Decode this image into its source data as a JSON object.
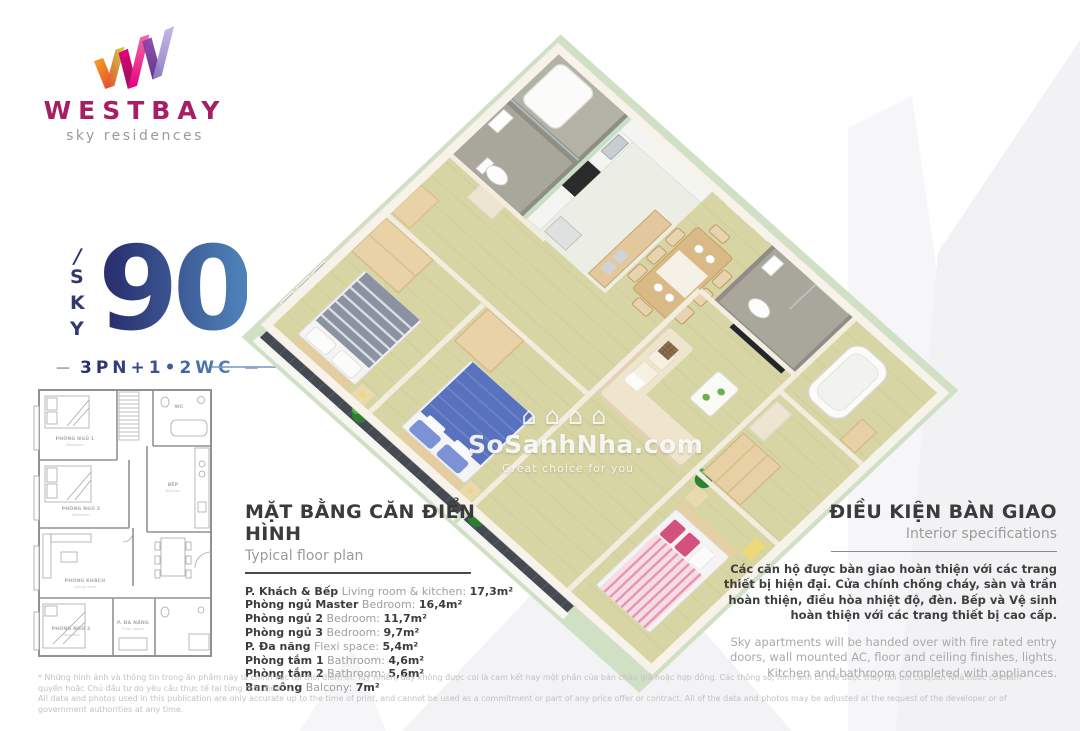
{
  "brand": {
    "name": "WESTBAY",
    "tagline": "sky residences"
  },
  "unit": {
    "slash": "/",
    "letters": [
      "S",
      "K",
      "Y"
    ],
    "number": "90",
    "dash": "—",
    "config": "3PN+1•2WC"
  },
  "floor_plan_2d": {
    "rooms": [
      {
        "vi": "PHÒNG NGỦ 1",
        "en": "Bedroom"
      },
      {
        "vi": "PHÒNG NGỦ 2",
        "en": "Bedroom"
      },
      {
        "vi": "PHÒNG KHÁCH",
        "en": "Living room"
      },
      {
        "vi": "PHÒNG NGỦ 3",
        "en": "Bedroom"
      },
      {
        "vi": "BẾP",
        "en": "Kitchen"
      },
      {
        "vi": "P. ĐA NĂNG",
        "en": "Flexi space"
      },
      {
        "vi": "WC",
        "en": ""
      }
    ]
  },
  "typical_plan": {
    "title_vi": "MẶT BẰNG CĂN ĐIỂN HÌNH",
    "title_en": "Typical floor plan",
    "rooms": [
      {
        "vi": "P. Khách & Bếp",
        "en": "Living room & kitchen:",
        "area": "17,3m²"
      },
      {
        "vi": "Phòng ngủ Master",
        "en": "Bedroom:",
        "area": "16,4m²"
      },
      {
        "vi": "Phòng ngủ 2",
        "en": "Bedroom:",
        "area": "11,7m²"
      },
      {
        "vi": "Phòng ngủ 3",
        "en": "Bedroom:",
        "area": "9,7m²"
      },
      {
        "vi": "P. Đa năng",
        "en": "Flexi space:",
        "area": "5,4m²"
      },
      {
        "vi": "Phòng tắm 1",
        "en": "Bathroom:",
        "area": "4,6m²"
      },
      {
        "vi": "Phòng tắm 2",
        "en": "Bathroom:",
        "area": "5,6m²"
      },
      {
        "vi": "Ban công",
        "en": "Balcony:",
        "area": "7m²"
      }
    ]
  },
  "handover": {
    "title_vi": "ĐIỀU KIỆN BÀN GIAO",
    "title_en": "Interior specifications",
    "body_vi": "Các căn hộ được bàn giao hoàn thiện với các trang thiết bị hiện đại.  Cửa chính chống cháy, sàn và trần hoàn thiện, điều hòa nhiệt độ, đèn. Bếp và Vệ sinh hoàn thiện với các trang thiết bị cao cấp.",
    "body_en": "Sky apartments will be handed over with fire rated entry doors, wall mounted AC, floor and ceiling finishes, lights. Kitchen and bathroom completed with appliances."
  },
  "watermark": {
    "house_glyph": "⌂",
    "site": "SoSanhNha.com",
    "slogan": "Great choice for you"
  },
  "disclaimer": {
    "vi": "* Những hình ảnh và thông tin trong ấn phẩm này là chính xác tại thời điểm in. Tuy nhiên, đây không được coi là cam kết hay một phần của bản chào giá hoặc hợp đồng. Các thông số, hình ảnh có thể được thay đổi bởi cơ quan Nhà nước có thẩm quyền hoặc Chủ đầu tư do yêu cầu thực tế tại từng thời điểm. /",
    "en": "All data and photos used in this publication are only accurate up to the time of print, and cannot be used as a commitment or part of any price offer or contract. All of the data and photos may be adjusted at the request of the developer or of government authorities at any time."
  },
  "colors": {
    "brand_magenta": "#a81e64",
    "navy": "#2a3170",
    "sky_blue": "#4e80b8",
    "text_dark": "#3c3c3c",
    "text_gray": "#9e9e9e",
    "disclaimer_gray": "#c2c2c2",
    "slab_green": "#cfe0c4",
    "floor_wood": "#d8d5a4",
    "balcony_dark": "#454a52",
    "bed_blue": "#5872be",
    "bed_pink": "#f0c4d2",
    "accent_pink": "#d4517f",
    "watermark_gray": "#f3f3f5"
  }
}
